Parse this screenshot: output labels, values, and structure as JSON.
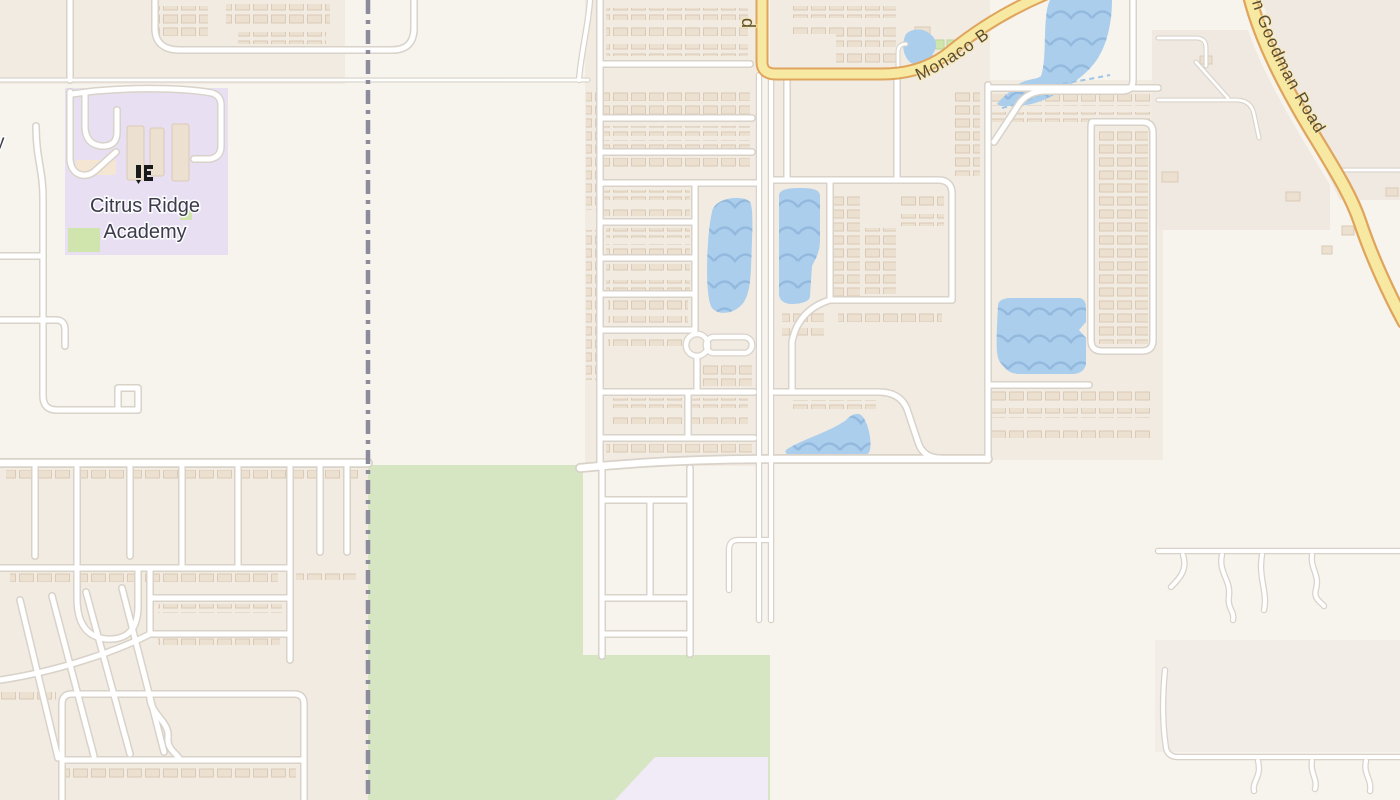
{
  "map": {
    "labels": {
      "academy_line1": "Citrus Ridge",
      "academy_line2": "Academy",
      "monaco_road": "Monaco B",
      "goodman_road": "n Goodman Road",
      "partial_road_label_p": "p",
      "partial_label_y": "y"
    },
    "features": {
      "school_area_name": "Citrus Ridge Academy",
      "water_body_count": 6,
      "boundary_style": "dashed vertical administrative boundary",
      "park_area": "large green open space, lower center-left",
      "roundabout": "small roundabout in central subdivision"
    },
    "colors": {
      "background": "#f7f3ed",
      "residential": "#f2ebe2",
      "rural": "#efe9e1",
      "park_green": "#d6e5c2",
      "school_purple": "#e8e0f2",
      "lavender_area": "#f1eaf7",
      "water_blue": "#abceec",
      "water_wave": "#93bade",
      "water_dash": "#9ec4e6",
      "road_fill": "#ffffff",
      "road_casing": "#d8d2c9",
      "highway_fill": "#f8e9a2",
      "highway_casing": "#dfa55e",
      "boundary_gray": "#8b8b9c",
      "label_text": "#3b3b4b",
      "road_label_text": "#5a4c32",
      "building_fill": "#ece0d0",
      "building_outline": "#dbcab6",
      "pitch_green": "#cfe5ad",
      "school_icon": "#1a1a1a"
    }
  }
}
